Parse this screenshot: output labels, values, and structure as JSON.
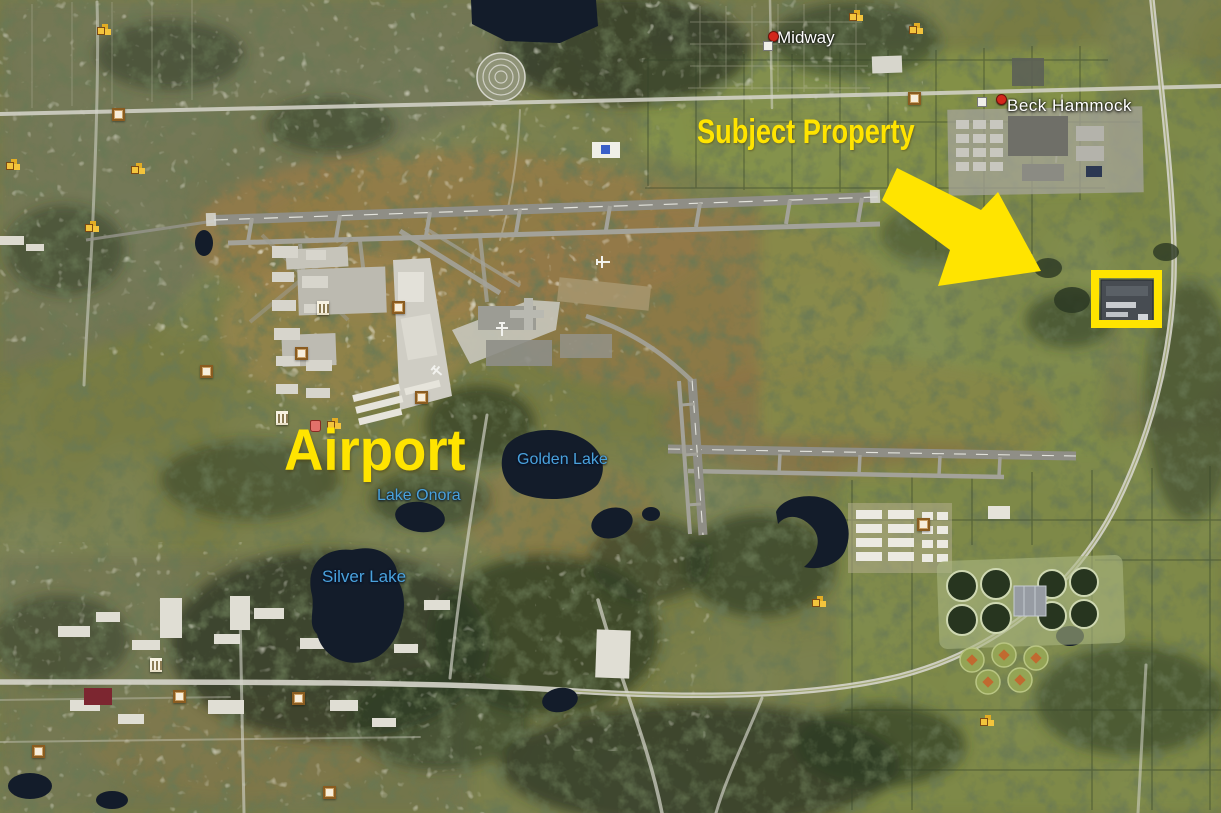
{
  "map": {
    "annotations": {
      "subject_property": {
        "label": "Subject Property",
        "color": "#ffe400"
      },
      "airport": {
        "label": "Airport",
        "color": "#ffe400"
      },
      "highlight_box_color": "#ffe400"
    },
    "place_labels": [
      {
        "name": "Midway"
      },
      {
        "name": "Beck Hammock"
      }
    ],
    "lake_labels": [
      {
        "name": "Golden Lake"
      },
      {
        "name": "Lake Onora"
      },
      {
        "name": "Silver Lake"
      }
    ],
    "label_colors": {
      "place": "#ffffff",
      "lake": "#4aa2dc"
    },
    "icons": [
      {
        "name": "red-dot-marker"
      },
      {
        "name": "white-square-icon"
      },
      {
        "name": "square-placemark-icon"
      },
      {
        "name": "building-cluster-icon"
      },
      {
        "name": "landmark-icon"
      },
      {
        "name": "lodging-icon"
      },
      {
        "name": "airplane-icon"
      }
    ]
  }
}
